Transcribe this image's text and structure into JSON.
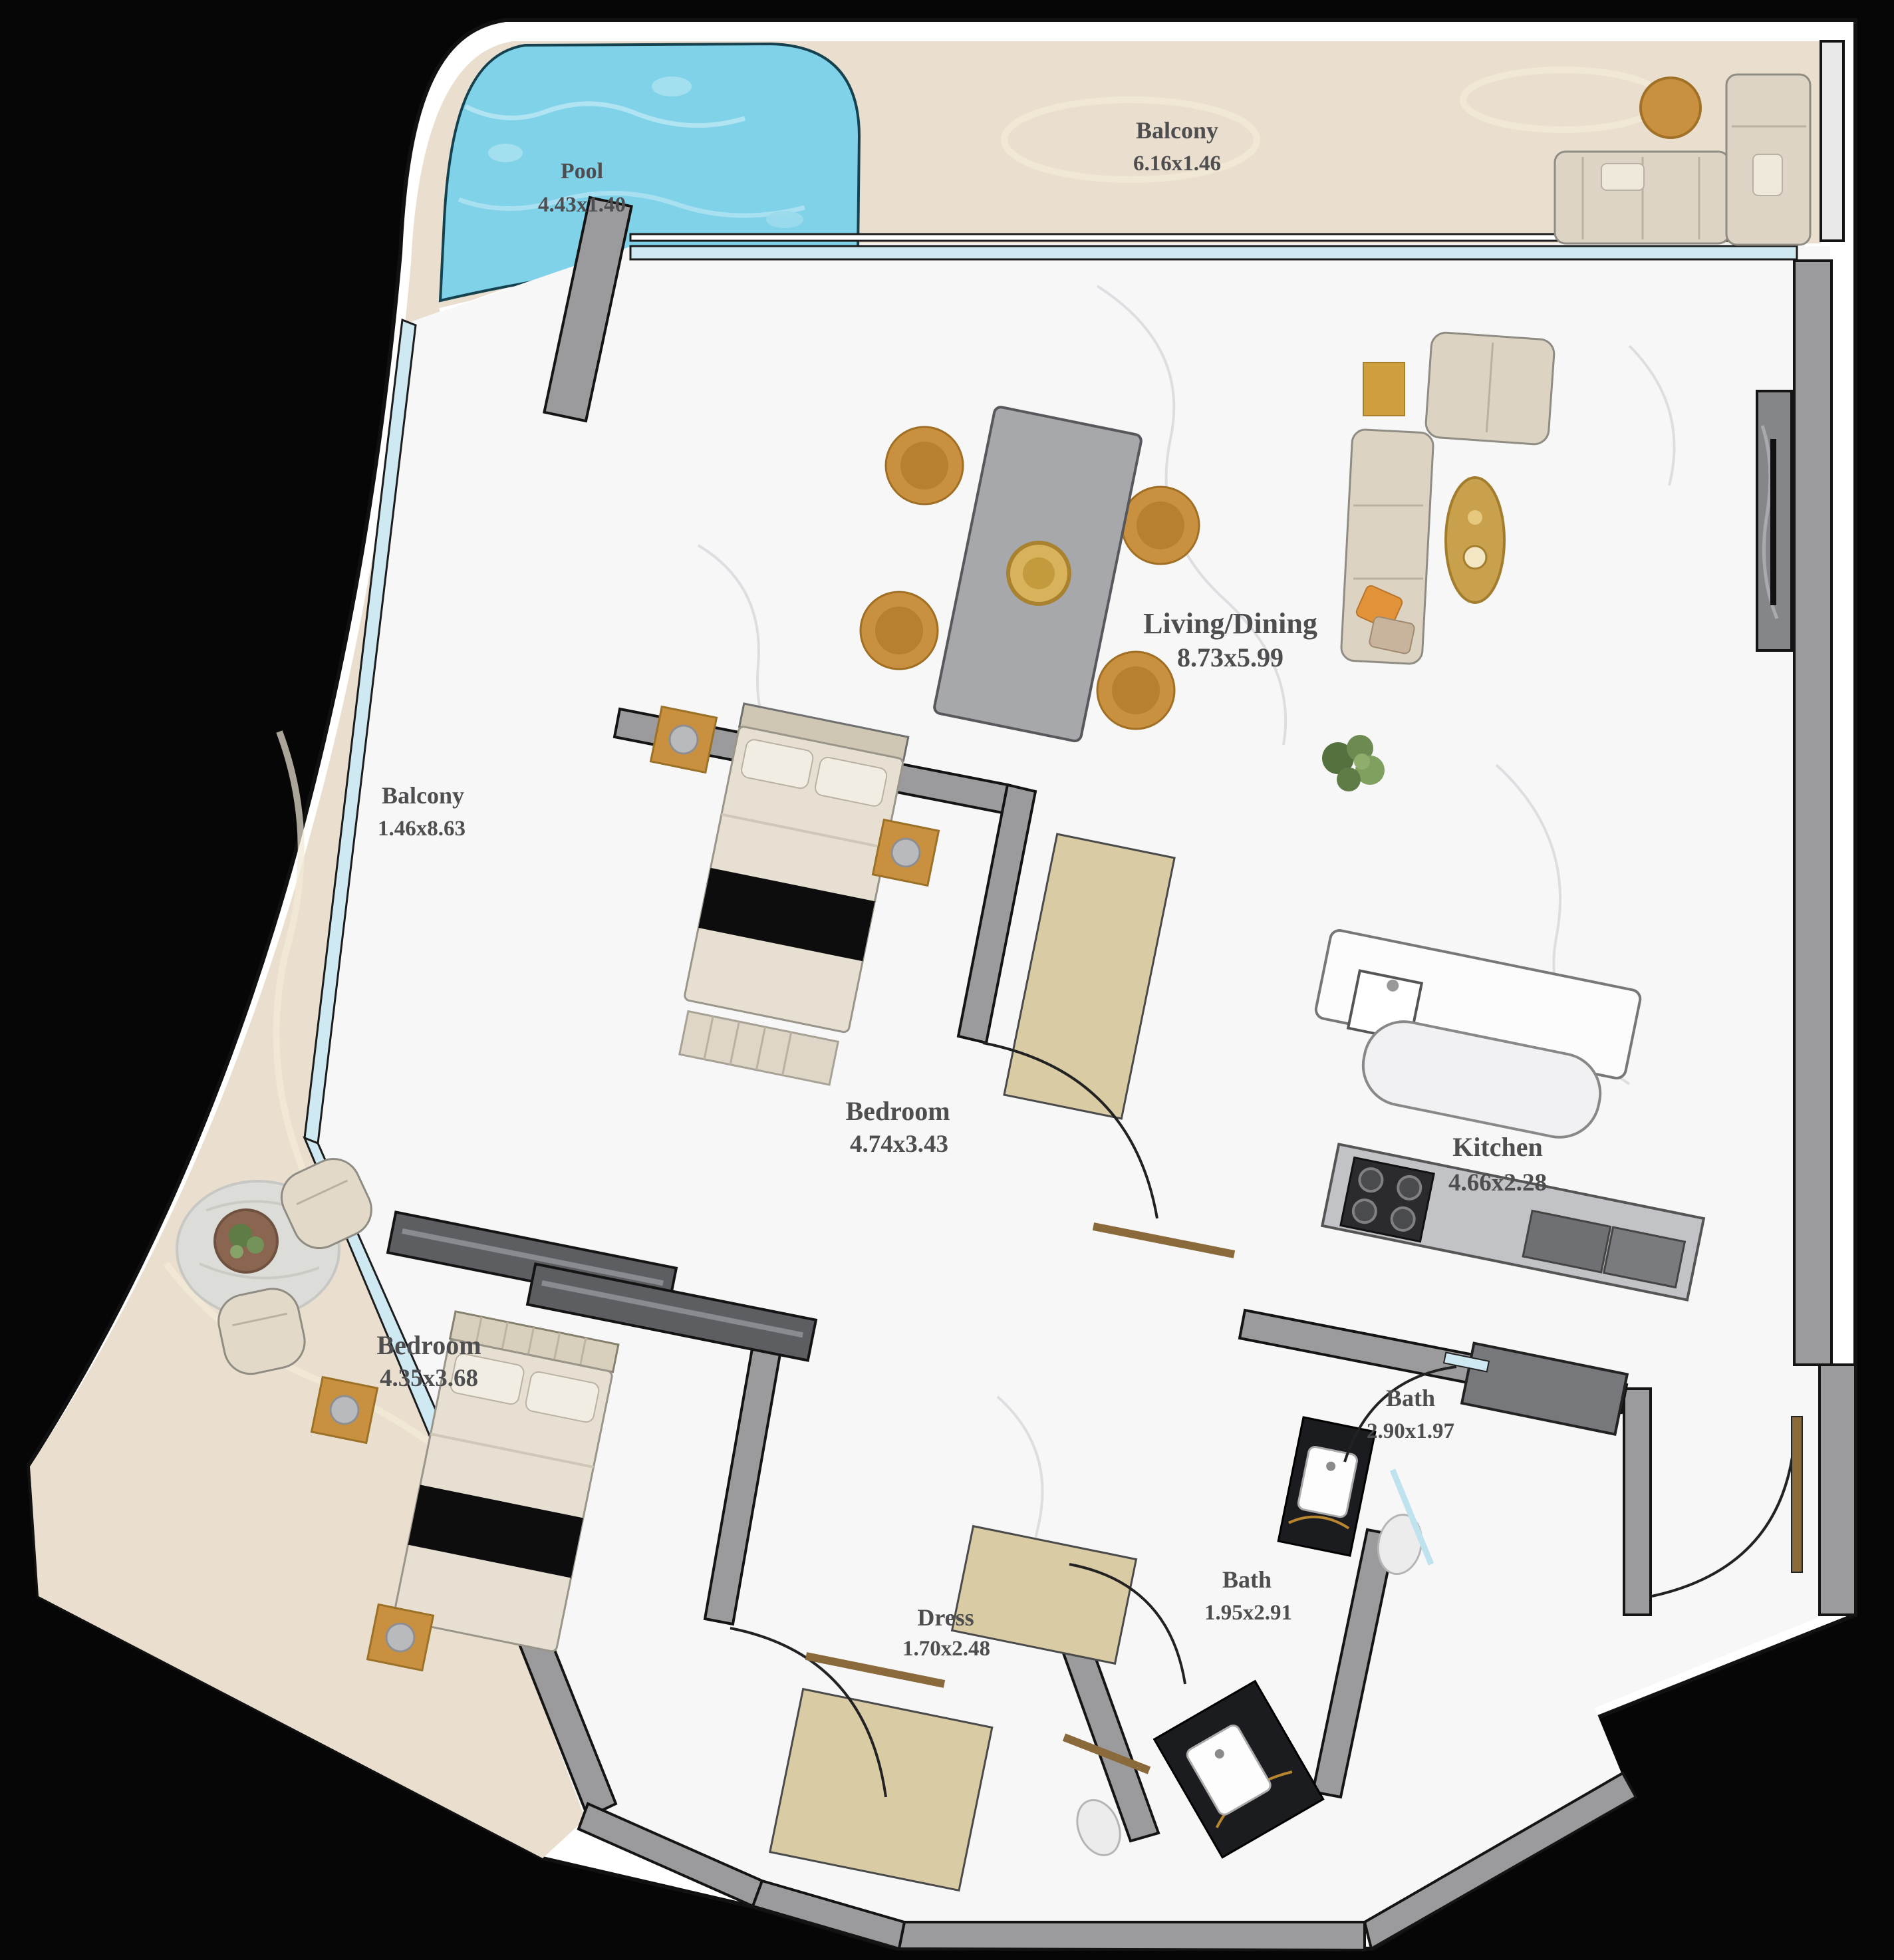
{
  "page": {
    "type": "apartment-floor-plan",
    "background": "#060606"
  },
  "colors": {
    "plan_white": "#ffffff",
    "floor_marble": "#f7f7f8",
    "balcony_stone": "#eadfce",
    "pool_water": "#7fd2e8",
    "wall_gray": "#9b9b9e",
    "wardrobe_dark": "#5d5e62",
    "glass_blue": "#cfe9f2",
    "gold_accent": "#c9913f",
    "marble_black": "#1b1c1f",
    "door_wood": "#8a6a3a",
    "label_text": "#4e4e50"
  },
  "rooms": [
    {
      "id": "pool",
      "name": "Pool",
      "dims": "4.43x1.40"
    },
    {
      "id": "balcony-top",
      "name": "Balcony",
      "dims": "6.16x1.46"
    },
    {
      "id": "living-dining",
      "name": "Living/Dining",
      "dims": "8.73x5.99"
    },
    {
      "id": "balcony-left",
      "name": "Balcony",
      "dims": "1.46x8.63"
    },
    {
      "id": "bedroom-1",
      "name": "Bedroom",
      "dims": "4.74x3.43"
    },
    {
      "id": "kitchen",
      "name": "Kitchen",
      "dims": "4.66x2.28"
    },
    {
      "id": "bedroom-2",
      "name": "Bedroom",
      "dims": "4.35x3.68"
    },
    {
      "id": "bath-1",
      "name": "Bath",
      "dims": "2.90x1.97"
    },
    {
      "id": "bath-2",
      "name": "Bath",
      "dims": "1.95x2.91"
    },
    {
      "id": "dress",
      "name": "Dress",
      "dims": "1.70x2.48"
    }
  ]
}
